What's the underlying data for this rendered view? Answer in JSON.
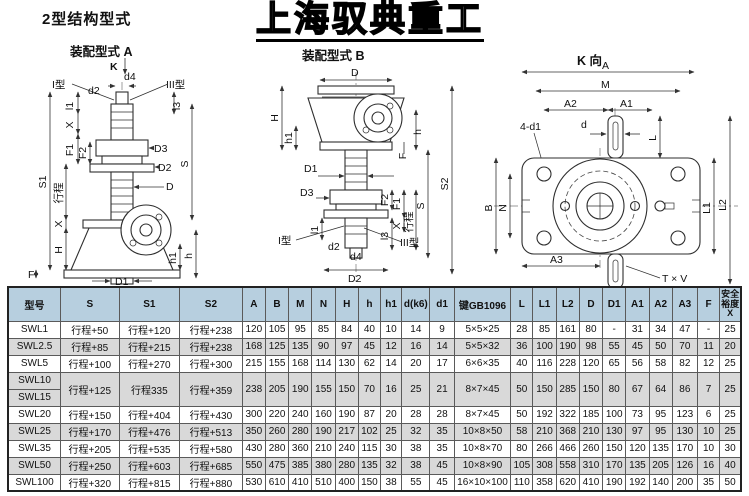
{
  "page": {
    "title": "2型结构型式",
    "watermark": "上海驭典重工"
  },
  "captions": {
    "a": "装配型式 A",
    "b": "装配型式 B",
    "k": "K 向"
  },
  "drawing_labels": {
    "a": {
      "k": "K",
      "type1": "I型",
      "d2": "d2",
      "d4": "d4",
      "type3": "III型",
      "l1": "l1",
      "x_top": "X",
      "f1": "F1",
      "f2": "F2",
      "stroke": "行程",
      "x_mid": "X",
      "h_big": "H",
      "s1": "S1",
      "f": "F",
      "l3": "l3",
      "d3": "D3",
      "d2_dia": "D2",
      "d_dia": "D",
      "s": "S",
      "h1": "h1",
      "h_small": "h",
      "d1": "D1"
    },
    "b": {
      "d_dia": "D",
      "h_big": "H",
      "h1": "h1",
      "h_small": "h",
      "f": "F",
      "d1": "D1",
      "d3": "D3",
      "f2": "F2",
      "f1": "F1",
      "x": "X",
      "stroke": "行程",
      "s": "S",
      "s2": "S2",
      "l1": "l1",
      "type1": "I型",
      "d2": "d2",
      "d4": "d4",
      "type3": "III型",
      "l3": "l3",
      "d2_dia": "D2"
    },
    "k": {
      "a": "A",
      "m": "M",
      "a2": "A2",
      "a1": "A1",
      "d1_4": "4-d1",
      "d": "d",
      "l": "L",
      "b": "B",
      "n": "N",
      "l1": "L1",
      "l2": "L2",
      "a3": "A3",
      "tv": "T × V"
    }
  },
  "table": {
    "columns": [
      "型号",
      "S",
      "S1",
      "S2",
      "A",
      "B",
      "M",
      "N",
      "H",
      "h",
      "h1",
      "d(k6)",
      "d1",
      "键GB1096",
      "L",
      "L1",
      "L2",
      "D",
      "D1",
      "A1",
      "A2",
      "A3",
      "F",
      "安全\n裕度\nX"
    ],
    "rows": [
      {
        "model": "SWL1",
        "span": 1,
        "cells": [
          "行程+50",
          "行程+120",
          "行程+238",
          "120",
          "105",
          "95",
          "85",
          "84",
          "40",
          "10",
          "14",
          "9",
          "5×5×25",
          "28",
          "85",
          "161",
          "80",
          "-",
          "31",
          "34",
          "47",
          "-",
          "25"
        ]
      },
      {
        "model": "SWL2.5",
        "span": 1,
        "cells": [
          "行程+85",
          "行程+215",
          "行程+238",
          "168",
          "125",
          "135",
          "90",
          "97",
          "45",
          "12",
          "16",
          "14",
          "5×5×32",
          "36",
          "100",
          "190",
          "98",
          "55",
          "45",
          "50",
          "70",
          "11",
          "20"
        ]
      },
      {
        "model": "SWL5",
        "span": 1,
        "cells": [
          "行程+100",
          "行程+270",
          "行程+300",
          "215",
          "155",
          "168",
          "114",
          "130",
          "62",
          "14",
          "20",
          "17",
          "6×6×35",
          "40",
          "116",
          "228",
          "120",
          "65",
          "56",
          "58",
          "82",
          "12",
          "25"
        ]
      },
      {
        "model": "SWL10",
        "span": 2,
        "cells": [
          "行程+125",
          "行程335",
          "行程+359",
          "238",
          "205",
          "190",
          "155",
          "150",
          "70",
          "16",
          "25",
          "21",
          "8×7×45",
          "50",
          "150",
          "285",
          "150",
          "80",
          "67",
          "64",
          "86",
          "7",
          "25"
        ]
      },
      {
        "model": "SWL15",
        "span": 1,
        "cells": []
      },
      {
        "model": "SWL20",
        "span": 1,
        "cells": [
          "行程+150",
          "行程+404",
          "行程+430",
          "300",
          "220",
          "240",
          "160",
          "190",
          "87",
          "20",
          "28",
          "28",
          "8×7×45",
          "50",
          "192",
          "322",
          "185",
          "100",
          "73",
          "95",
          "123",
          "6",
          "25"
        ]
      },
      {
        "model": "SWL25",
        "span": 1,
        "cells": [
          "行程+170",
          "行程+476",
          "行程+513",
          "350",
          "260",
          "280",
          "190",
          "217",
          "102",
          "25",
          "32",
          "35",
          "10×8×50",
          "58",
          "210",
          "368",
          "210",
          "130",
          "97",
          "95",
          "130",
          "10",
          "25"
        ]
      },
      {
        "model": "SWL35",
        "span": 1,
        "cells": [
          "行程+205",
          "行程+535",
          "行程+580",
          "430",
          "280",
          "360",
          "210",
          "240",
          "115",
          "30",
          "38",
          "35",
          "10×8×70",
          "80",
          "266",
          "466",
          "260",
          "150",
          "120",
          "135",
          "170",
          "10",
          "30"
        ]
      },
      {
        "model": "SWL50",
        "span": 1,
        "cells": [
          "行程+250",
          "行程+603",
          "行程+685",
          "550",
          "475",
          "385",
          "380",
          "280",
          "135",
          "32",
          "38",
          "45",
          "10×8×90",
          "105",
          "308",
          "558",
          "310",
          "170",
          "135",
          "205",
          "126",
          "16",
          "40"
        ]
      },
      {
        "model": "SWL100",
        "span": 1,
        "cells": [
          "行程+320",
          "行程+815",
          "行程+880",
          "530",
          "610",
          "410",
          "510",
          "400",
          "150",
          "38",
          "55",
          "45",
          "16×10×100",
          "110",
          "358",
          "620",
          "410",
          "190",
          "192",
          "140",
          "200",
          "35",
          "50"
        ]
      }
    ]
  }
}
